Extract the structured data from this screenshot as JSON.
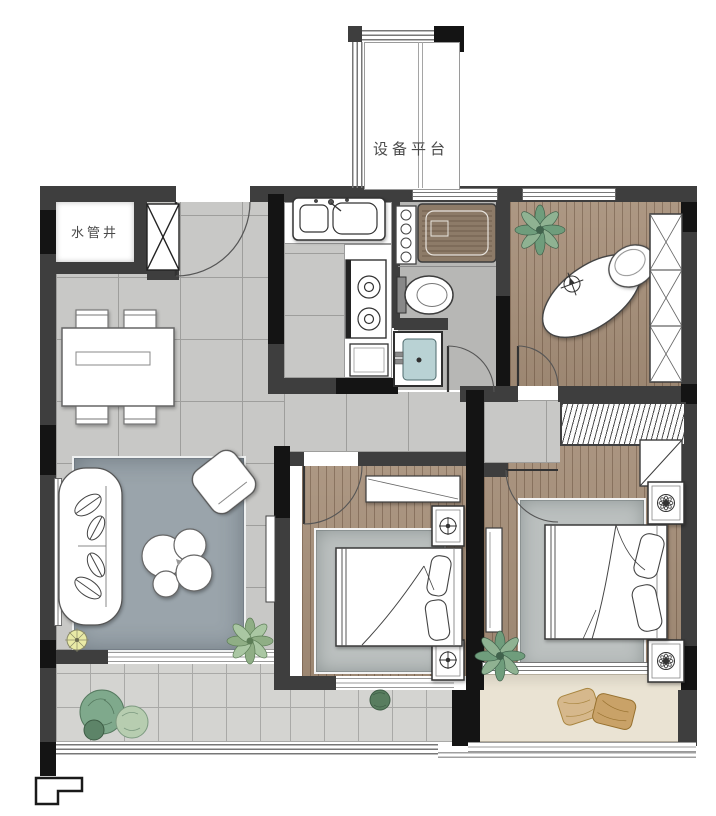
{
  "labels": {
    "equipment_platform": "设备平台",
    "water_pipe_shaft": "水管井"
  },
  "colors": {
    "wall_dark": "#3e3e3e",
    "wall_black": "#141414",
    "tile_floor": "#c8c8c6",
    "tile_line": "#9e9e9c",
    "balcony_tile": "#d4d4d1",
    "bath_tile": "#b7b7b5",
    "wood_floor": "#a68f79",
    "rug_living": "#9aa4ab",
    "rug_bedroom": "#bcc1c0",
    "bay_seat": "#eae3d3",
    "basin_teal": "#b9d2d4",
    "plant_green": "#6f9d7c",
    "plant_light": "#aac7a3",
    "pillow_tan": "#d6b88c",
    "pillow_tan_dark": "#c9a268",
    "lamp_yellow": "#e9eaa6",
    "furniture_white": "#ffffff",
    "line_color": "#4a4a4a"
  },
  "rooms": {
    "entry_dining": {
      "furniture": [
        "entrance-door",
        "dining-table",
        "dining-chairs-x4",
        "shaft-x-symbol"
      ]
    },
    "kitchen": {
      "furniture": [
        "double-sink",
        "gas-stove",
        "base-cabinet"
      ]
    },
    "bathroom": {
      "furniture": [
        "bathtub",
        "toilet",
        "washbasin",
        "storage-shelf"
      ]
    },
    "study_bedroom": {
      "furniture": [
        "oval-desk",
        "desk-chair",
        "x-front-wardrobe",
        "plant"
      ]
    },
    "master_bedroom": {
      "furniture": [
        "double-bed",
        "nightstand-x2",
        "hanger-wardrobe",
        "corner-closet",
        "side-cabinet",
        "rug",
        "plant",
        "bay-window-pillows"
      ]
    },
    "second_bedroom": {
      "furniture": [
        "double-bed",
        "nightstand-x2",
        "desk",
        "rug"
      ]
    },
    "living_room": {
      "furniture": [
        "sofa",
        "armchair",
        "round-coffee-tables",
        "floor-lamp",
        "wall-tv",
        "rug",
        "plant"
      ]
    },
    "balcony": {
      "furniture": [
        "plants",
        "glass-railing",
        "step-symbol"
      ]
    },
    "equipment_platform": {
      "furniture": [
        "railing",
        "column"
      ]
    }
  }
}
